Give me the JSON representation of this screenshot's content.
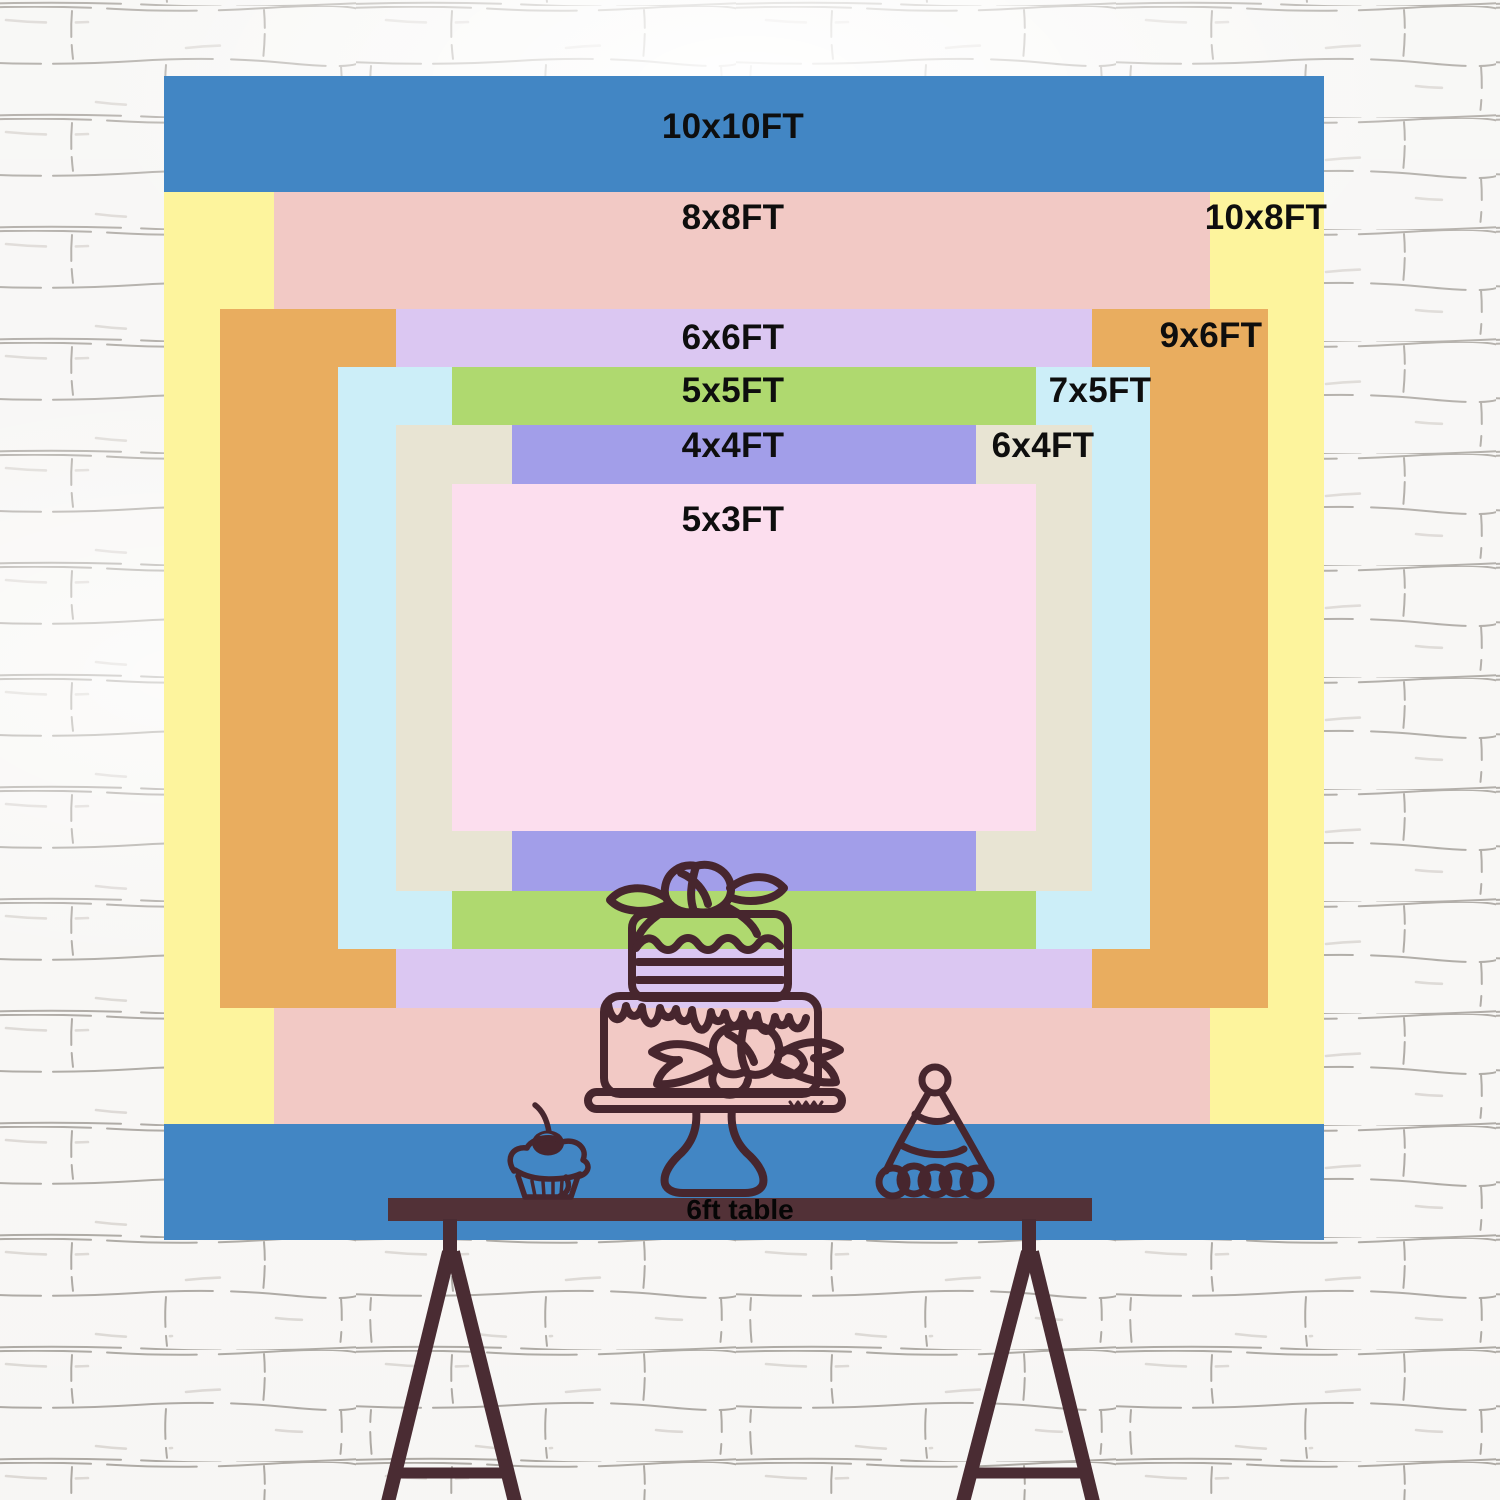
{
  "wall": {
    "base_color": "#f7f6f4",
    "mortar_line_color": "#8f8983",
    "mortar_light_color": "#c4beb7"
  },
  "backdrop_chart": {
    "type": "nested-size-comparison",
    "unit": "FT",
    "label_text_color": "#0e0e0e",
    "sizes": [
      {
        "id": "10x10",
        "label": "10x10FT",
        "color": "#4286c4",
        "x": 164,
        "y": 76,
        "w": 1160,
        "h": 1164,
        "label_cx": 733,
        "label_cy": 127
      },
      {
        "id": "10x8",
        "label": "10x8FT",
        "color": "#fdf49d",
        "x": 164,
        "y": 192,
        "w": 1160,
        "h": 932,
        "label_cx": 1266,
        "label_cy": 218
      },
      {
        "id": "8x8",
        "label": "8x8FT",
        "color": "#f2c9c5",
        "x": 274,
        "y": 192,
        "w": 936,
        "h": 932,
        "label_cx": 733,
        "label_cy": 218
      },
      {
        "id": "9x6",
        "label": "9x6FT",
        "color": "#e9ad5f",
        "x": 220,
        "y": 309,
        "w": 1048,
        "h": 699,
        "label_cx": 1211,
        "label_cy": 336
      },
      {
        "id": "6x6",
        "label": "6x6FT",
        "color": "#dbc7f2",
        "x": 396,
        "y": 309,
        "w": 696,
        "h": 699,
        "label_cx": 733,
        "label_cy": 338
      },
      {
        "id": "7x5",
        "label": "7x5FT",
        "color": "#cceef8",
        "x": 338,
        "y": 367,
        "w": 812,
        "h": 582,
        "label_cx": 1100,
        "label_cy": 391
      },
      {
        "id": "5x5",
        "label": "5x5FT",
        "color": "#afd96f",
        "x": 452,
        "y": 367,
        "w": 584,
        "h": 582,
        "label_cx": 733,
        "label_cy": 391
      },
      {
        "id": "6x4",
        "label": "6x4FT",
        "color": "#e8e4d3",
        "x": 396,
        "y": 425,
        "w": 696,
        "h": 466,
        "label_cx": 1043,
        "label_cy": 446
      },
      {
        "id": "4x4",
        "label": "4x4FT",
        "color": "#a29ee9",
        "x": 512,
        "y": 425,
        "w": 464,
        "h": 466,
        "label_cx": 733,
        "label_cy": 446
      },
      {
        "id": "5x3",
        "label": "5x3FT",
        "color": "#fcdeee",
        "x": 452,
        "y": 484,
        "w": 584,
        "h": 347,
        "label_cx": 733,
        "label_cy": 520
      }
    ]
  },
  "table": {
    "label": "6ft table",
    "label_color": "#060606",
    "label_cx": 740,
    "label_cy": 1210,
    "bar": {
      "x": 388,
      "y": 1198,
      "w": 704,
      "h": 23,
      "color": "#523137"
    },
    "leg_color": "#4a2c33"
  },
  "illustration": {
    "outline_color": "#47262e",
    "items": [
      "cupcake-with-cherry",
      "two-tier-cake-on-stand",
      "party-hat"
    ]
  }
}
